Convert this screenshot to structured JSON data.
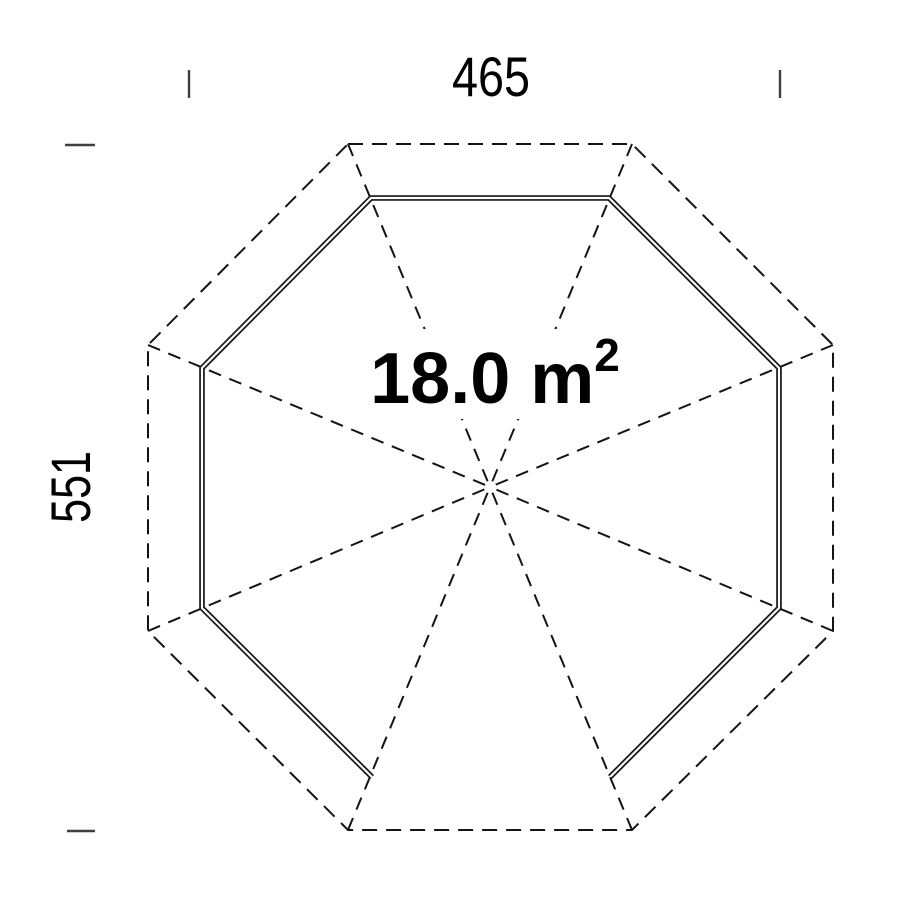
{
  "title": "Octagonal floor plan 18.0 m2",
  "colors": {
    "line": "#141414",
    "tick": "#3f3f3f",
    "text": "#000000",
    "background": "#ffffff"
  },
  "labels": {
    "width_dim": {
      "text": "465"
    },
    "depth_dim": {
      "text": "551"
    },
    "area": {
      "value": "18.0 m",
      "superscript": "2"
    }
  },
  "geometry": {
    "canvas": [
      901,
      901
    ],
    "center": [
      490,
      487
    ],
    "outer_octagon": [
      [
        348,
        144
      ],
      [
        632,
        144
      ],
      [
        833,
        345
      ],
      [
        833,
        631
      ],
      [
        632,
        830
      ],
      [
        348,
        830
      ],
      [
        148,
        631
      ],
      [
        148,
        345
      ]
    ],
    "wall_chain": [
      [
        372,
        777
      ],
      [
        202,
        608
      ],
      [
        202,
        368
      ],
      [
        371,
        198
      ],
      [
        609,
        198
      ],
      [
        779,
        368
      ],
      [
        779,
        608
      ],
      [
        610,
        777
      ]
    ],
    "open_side": "bottom",
    "outer_dash": "15 9",
    "ridge_dash": "13 9",
    "ticks": [
      {
        "x1": 189,
        "y1": 70,
        "x2": 189,
        "y2": 98
      },
      {
        "x1": 780,
        "y1": 70,
        "x2": 780,
        "y2": 98
      },
      {
        "x1": 65,
        "y1": 145,
        "x2": 95,
        "y2": 145
      },
      {
        "x1": 67,
        "y1": 831,
        "x2": 95,
        "y2": 831
      }
    ],
    "area_mask": {
      "x": 357,
      "y": 329,
      "w": 278,
      "h": 90
    }
  }
}
